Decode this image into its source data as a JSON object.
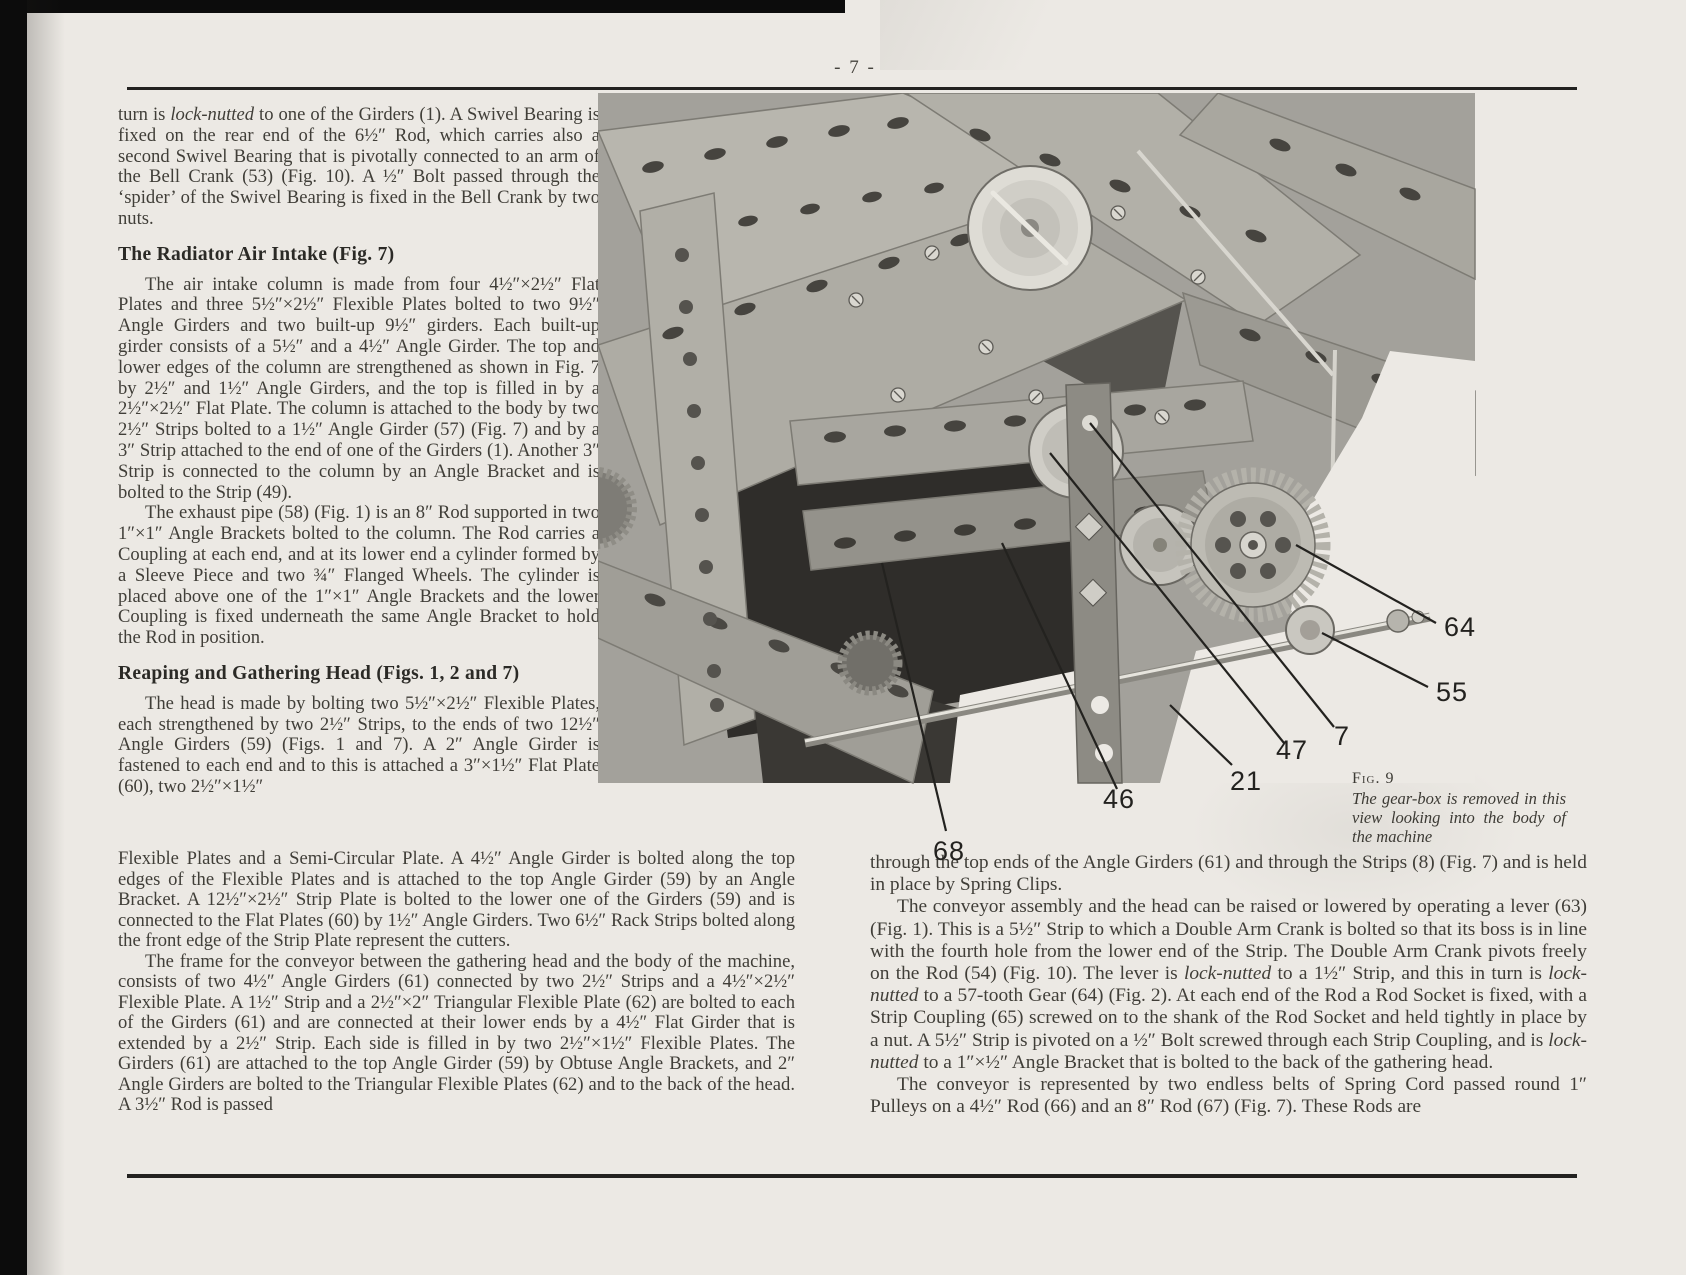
{
  "page": {
    "number_label": "- 7 -"
  },
  "article": {
    "col_left": {
      "para1": "turn is *lock-nutted* to one of the Girders (1). A Swivel Bearing is fixed on the rear end of the 6½″ Rod, which carries also a second Swivel Bearing that is pivotally connected to an arm of the Bell Crank (53) (Fig. 10). A ½″ Bolt passed through the ‘spider’ of the Swivel Bearing is fixed in the Bell Crank by two nuts.",
      "heading_radiator": "The Radiator Air Intake (Fig. 7)",
      "para2": "The air intake column is made from four 4½″×2½″ Flat Plates and three 5½″×2½″ Flexible Plates bolted to two 9½″ Angle Girders and two built-up 9½″ girders. Each built-up girder consists of a 5½″ and a 4½″ Angle Girder. The top and lower edges of the column are strengthened as shown in Fig. 7 by 2½″ and 1½″ Angle Girders, and the top is filled in by a 2½″×2½″ Flat Plate. The column is attached to the body by two 2½″ Strips bolted to a 1½″ Angle Girder (57) (Fig. 7) and by a 3″ Strip attached to the end of one of the Girders (1). Another 3″ Strip is connected to the column by an Angle Bracket and is bolted to the Strip (49).",
      "para3": "The exhaust pipe (58) (Fig. 1) is an 8″ Rod supported in two 1″×1″ Angle Brackets bolted to the column. The Rod carries a Coupling at each end, and at its lower end a cylinder formed by a Sleeve Piece and two ¾″ Flanged Wheels. The cylinder is placed above one of the 1″×1″ Angle Brackets and the lower Coupling is fixed underneath the same Angle Bracket to hold the Rod in position.",
      "heading_reaping": "Reaping and Gathering Head (Figs. 1, 2 and 7)",
      "para4": "The head is made by bolting two 5½″×2½″ Flexible Plates, each strengthened by two 2½″ Strips, to the ends of two 12½″ Angle Girders (59) (Figs. 1 and 7). A 2″ Angle Girder is fastened to each end and to this is attached a 3″×1½″ Flat Plate (60), two 2½″×1½″"
    },
    "col_left_wide": {
      "para4b": "Flexible Plates and a Semi-Circular Plate. A 4½″ Angle Girder is bolted along the top edges of the Flexible Plates and is attached to the top Angle Girder (59) by an Angle Bracket. A 12½″×2½″ Strip Plate is bolted to the lower one of the Girders (59) and is connected to the Flat Plates (60) by 1½″ Angle Girders. Two 6½″ Rack Strips bolted along the front edge of the Strip Plate represent the cutters.",
      "para5": "The frame for the conveyor between the gathering head and the body of the machine, consists of two 4½″ Angle Girders (61) connected by two 2½″ Strips and a 4½″×2½″ Flexible Plate. A 1½″ Strip and a 2½″×2″ Triangular Flexible Plate (62) are bolted to each of the Girders (61) and are connected at their lower ends by a 4½″ Flat Girder that is extended by a 2½″ Strip. Each side is filled in by two 2½″×1½″ Flexible Plates. The Girders (61) are attached to the top Angle Girder (59) by Obtuse Angle Brackets, and 2″ Angle Girders are bolted to the Triangular Flexible Plates (62) and to the back of the head. A 3½″ Rod is passed"
    },
    "col_right": {
      "para1": "through the top ends of the Angle Girders (61) and through the Strips (8) (Fig. 7) and is held in place by Spring Clips.",
      "para2": "The conveyor assembly and the head can be raised or lowered by operating a lever (63) (Fig. 1). This is a 5½″ Strip to which a Double Arm Crank is bolted so that its boss is in line with the fourth hole from the lower end of the Strip. The Double Arm Crank pivots freely on the Rod (54) (Fig. 10). The lever is *lock-nutted* to a 1½″ Strip, and this in turn is *lock-nutted* to a 57-tooth Gear (64) (Fig. 2). At each end of the Rod a Rod Socket is fixed, with a Strip Coupling (65) screwed on to the shank of the Rod Socket and held tightly in place by a nut. A 5½″ Strip is pivoted on a ½″ Bolt screwed through each Strip Coupling, and is *lock-nutted* to a 1″×½″ Angle Bracket that is bolted to the back of the gathering head.",
      "para3": "The conveyor is represented by two endless belts of Spring Cord passed round 1″ Pulleys on a 4½″ Rod (66) and an 8″ Rod (67) (Fig. 7). These Rods are"
    }
  },
  "figure": {
    "label": "Fig. 9",
    "caption": "The gear-box is removed in this view looking into the body of the machine",
    "callouts": [
      "64",
      "55",
      "7",
      "47",
      "21",
      "46",
      "68"
    ]
  }
}
